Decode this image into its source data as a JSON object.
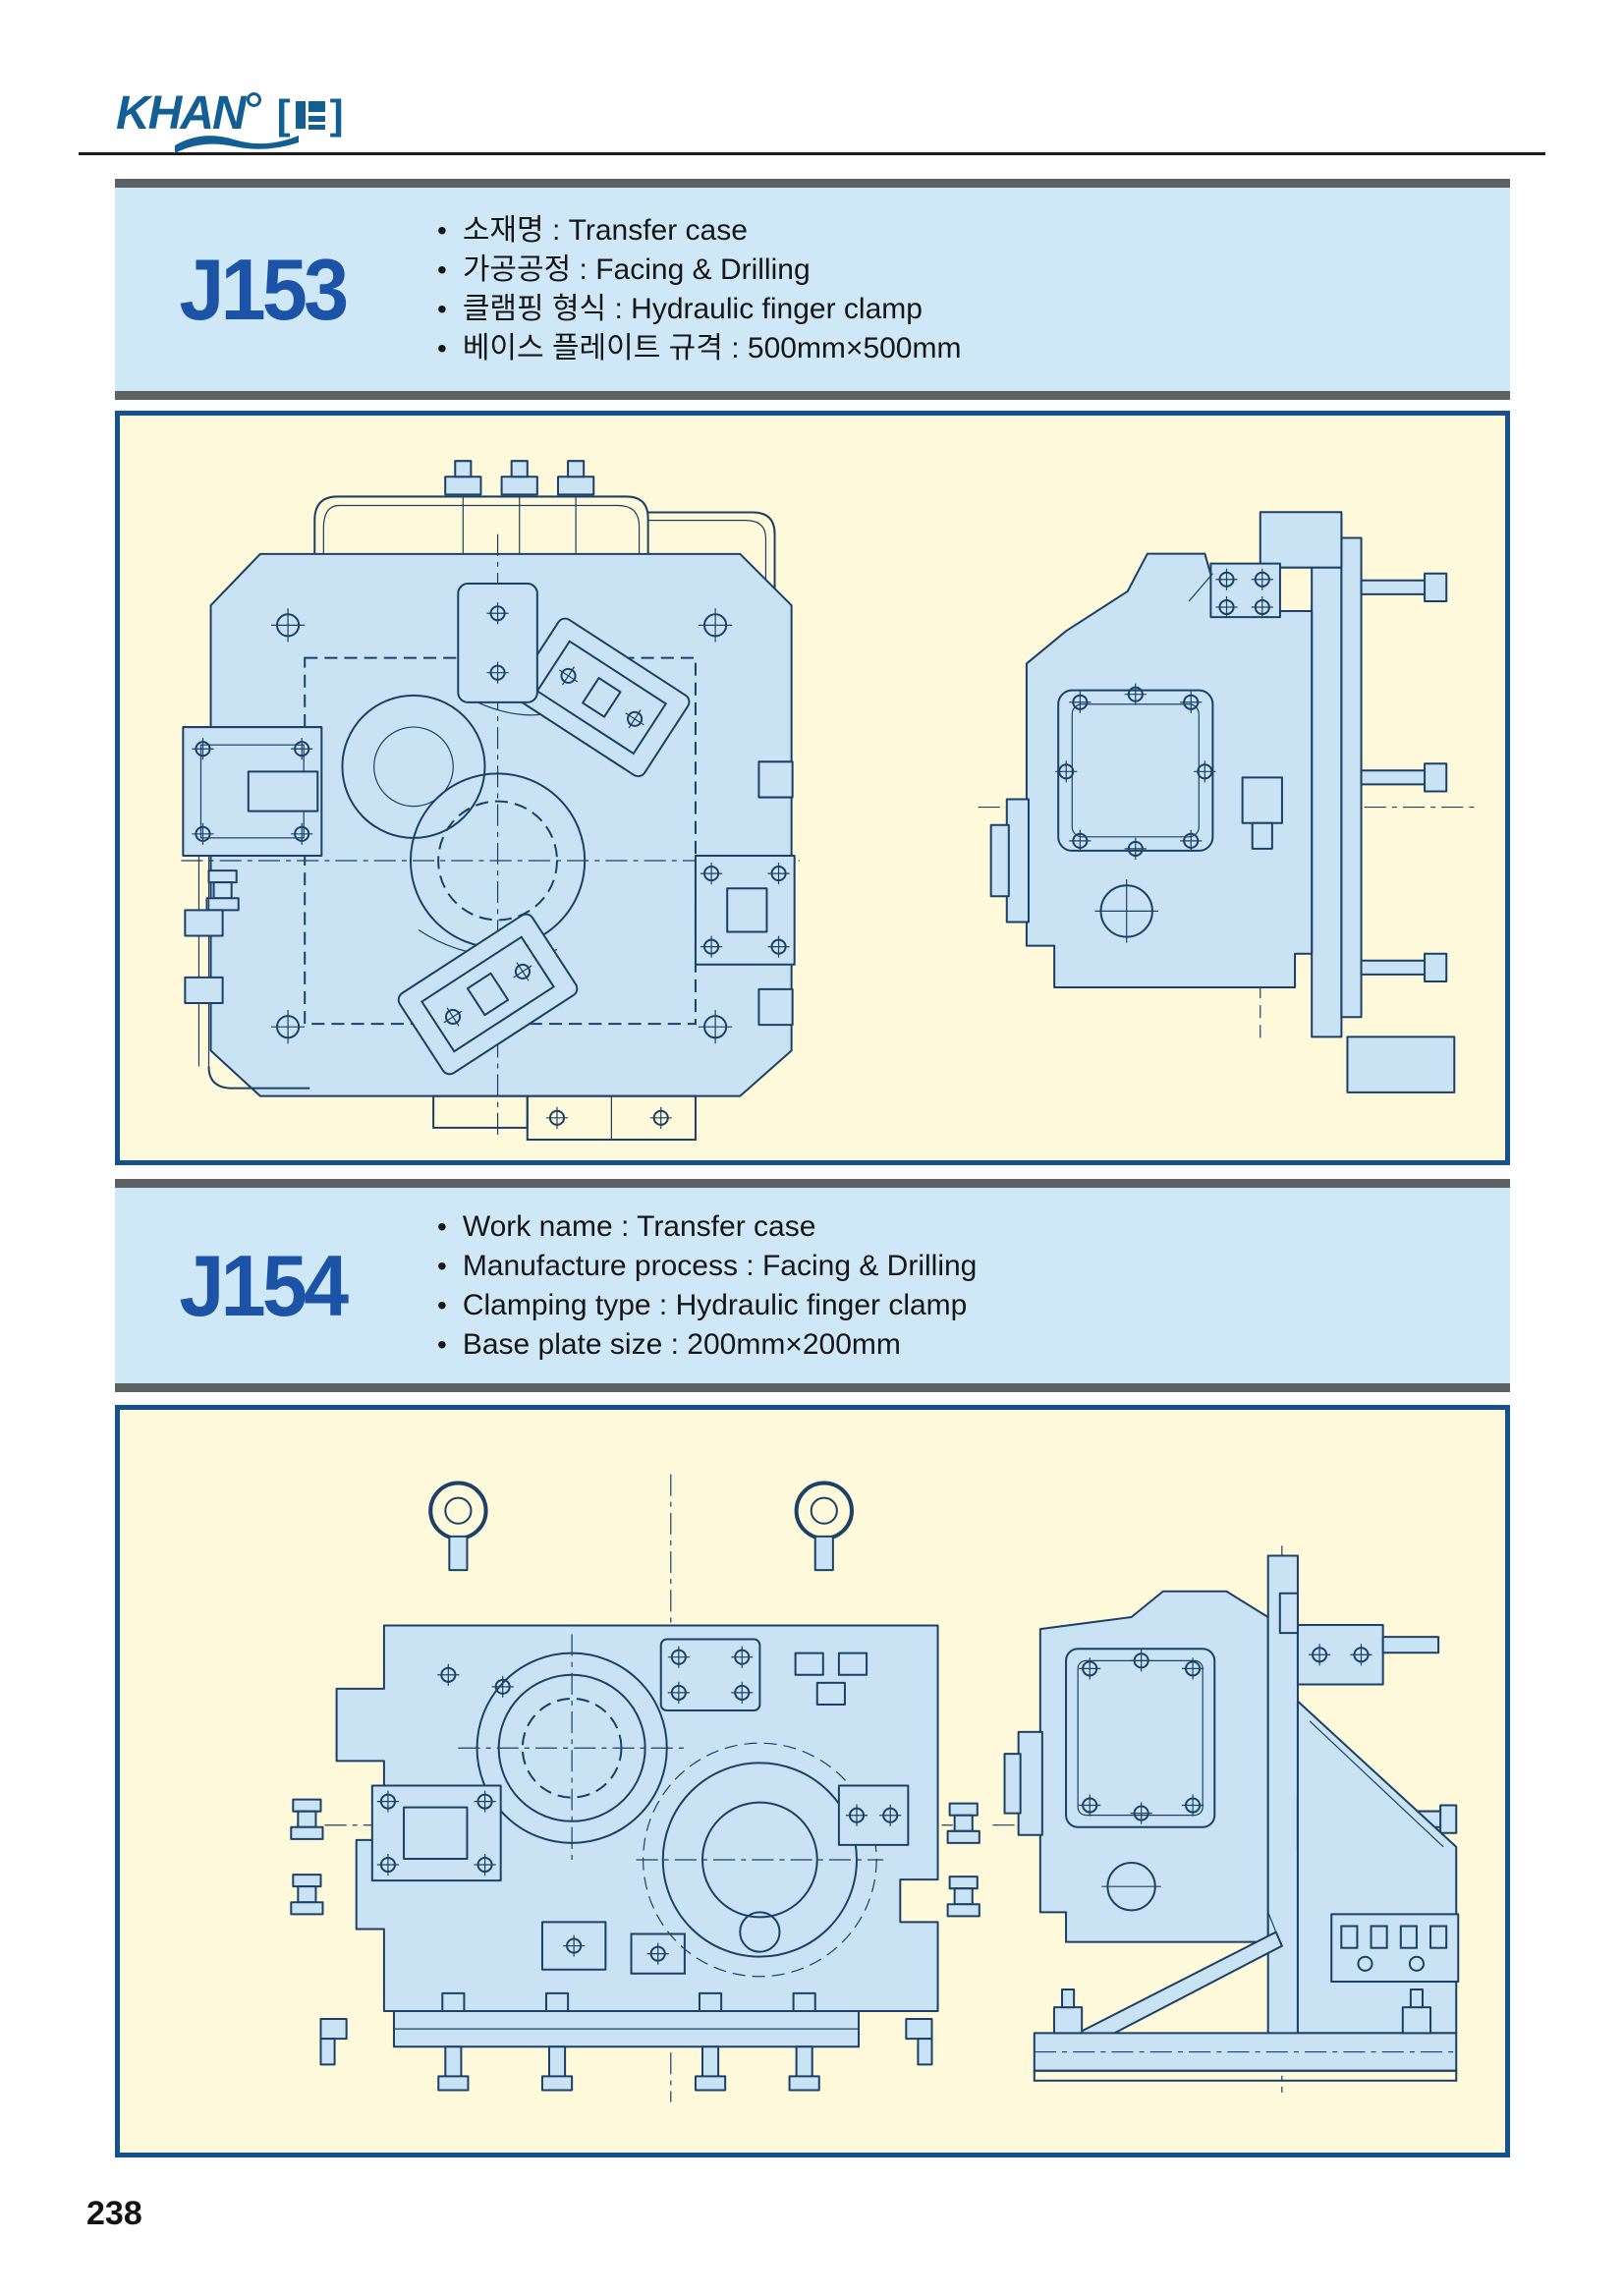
{
  "logo": {
    "brand": "KHAN",
    "bracket_left": "[",
    "bracket_right": "]"
  },
  "sections": [
    {
      "code": "J153",
      "bullets": [
        "소재명 : Transfer case",
        "가공공정 : Facing & Drilling",
        "클램핑 형식 : Hydraulic finger clamp",
        "베이스 플레이트 규격 : 500mm×500mm"
      ]
    },
    {
      "code": "J154",
      "bullets": [
        "Work name : Transfer case",
        "Manufacture process : Facing & Drilling",
        "Clamping type : Hydraulic finger clamp",
        "Base plate size : 200mm×200mm"
      ]
    }
  ],
  "page_number": "238",
  "colors": {
    "logo_blue": "#135e93",
    "code_blue": "#1c53a6",
    "header_bg": "#cfe8f8",
    "bar_gray": "#5e6164",
    "panel_border": "#14518f",
    "panel_cream": "#fdf9da",
    "drawing_fill": "#c9e3f5",
    "drawing_line": "#1d4166"
  },
  "icons": {
    "logo_swoosh": "wave-swoosh",
    "logo_dot": "small-circle",
    "logo_seal": "seal-stamp"
  }
}
